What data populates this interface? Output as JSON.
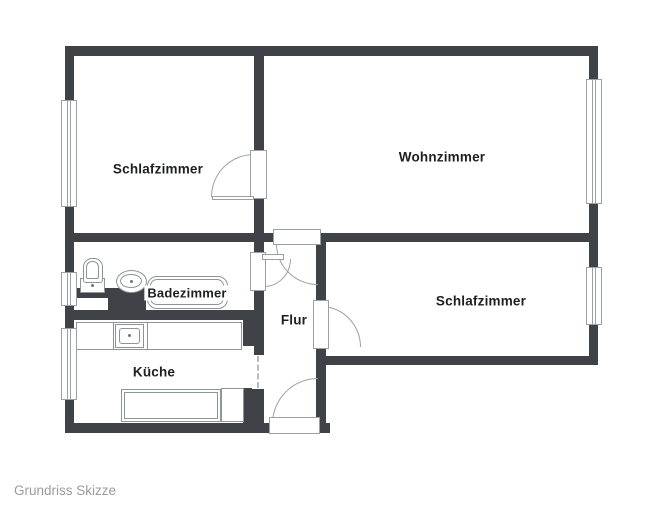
{
  "caption": "Grundriss Skizze",
  "colors": {
    "wall": "#3f4347",
    "line": "#9aa0a4",
    "fixture": "#8d959a",
    "label": "#1d2022",
    "caption": "#9b9b9b",
    "background": "#ffffff"
  },
  "rooms": [
    {
      "id": "bedroom-left",
      "label": "Schlafzimmer"
    },
    {
      "id": "living-room",
      "label": "Wohnzimmer"
    },
    {
      "id": "bathroom",
      "label": "Badezimmer"
    },
    {
      "id": "hallway",
      "label": "Flur"
    },
    {
      "id": "bedroom-right",
      "label": "Schlafzimmer"
    },
    {
      "id": "kitchen",
      "label": "Küche"
    }
  ],
  "fixtures": [
    "toilet",
    "washbasin",
    "bathtub",
    "kitchen-sink",
    "kitchen-counter",
    "kitchen-cabinet",
    "appliance"
  ],
  "doors": [
    "bedroom-left-door",
    "living-room-door",
    "bathroom-door",
    "bedroom-right-door",
    "entrance-door",
    "kitchen-opening"
  ],
  "windows": [
    "bedroom-left-window",
    "bathroom-window",
    "kitchen-window",
    "living-room-window",
    "bedroom-right-window"
  ]
}
